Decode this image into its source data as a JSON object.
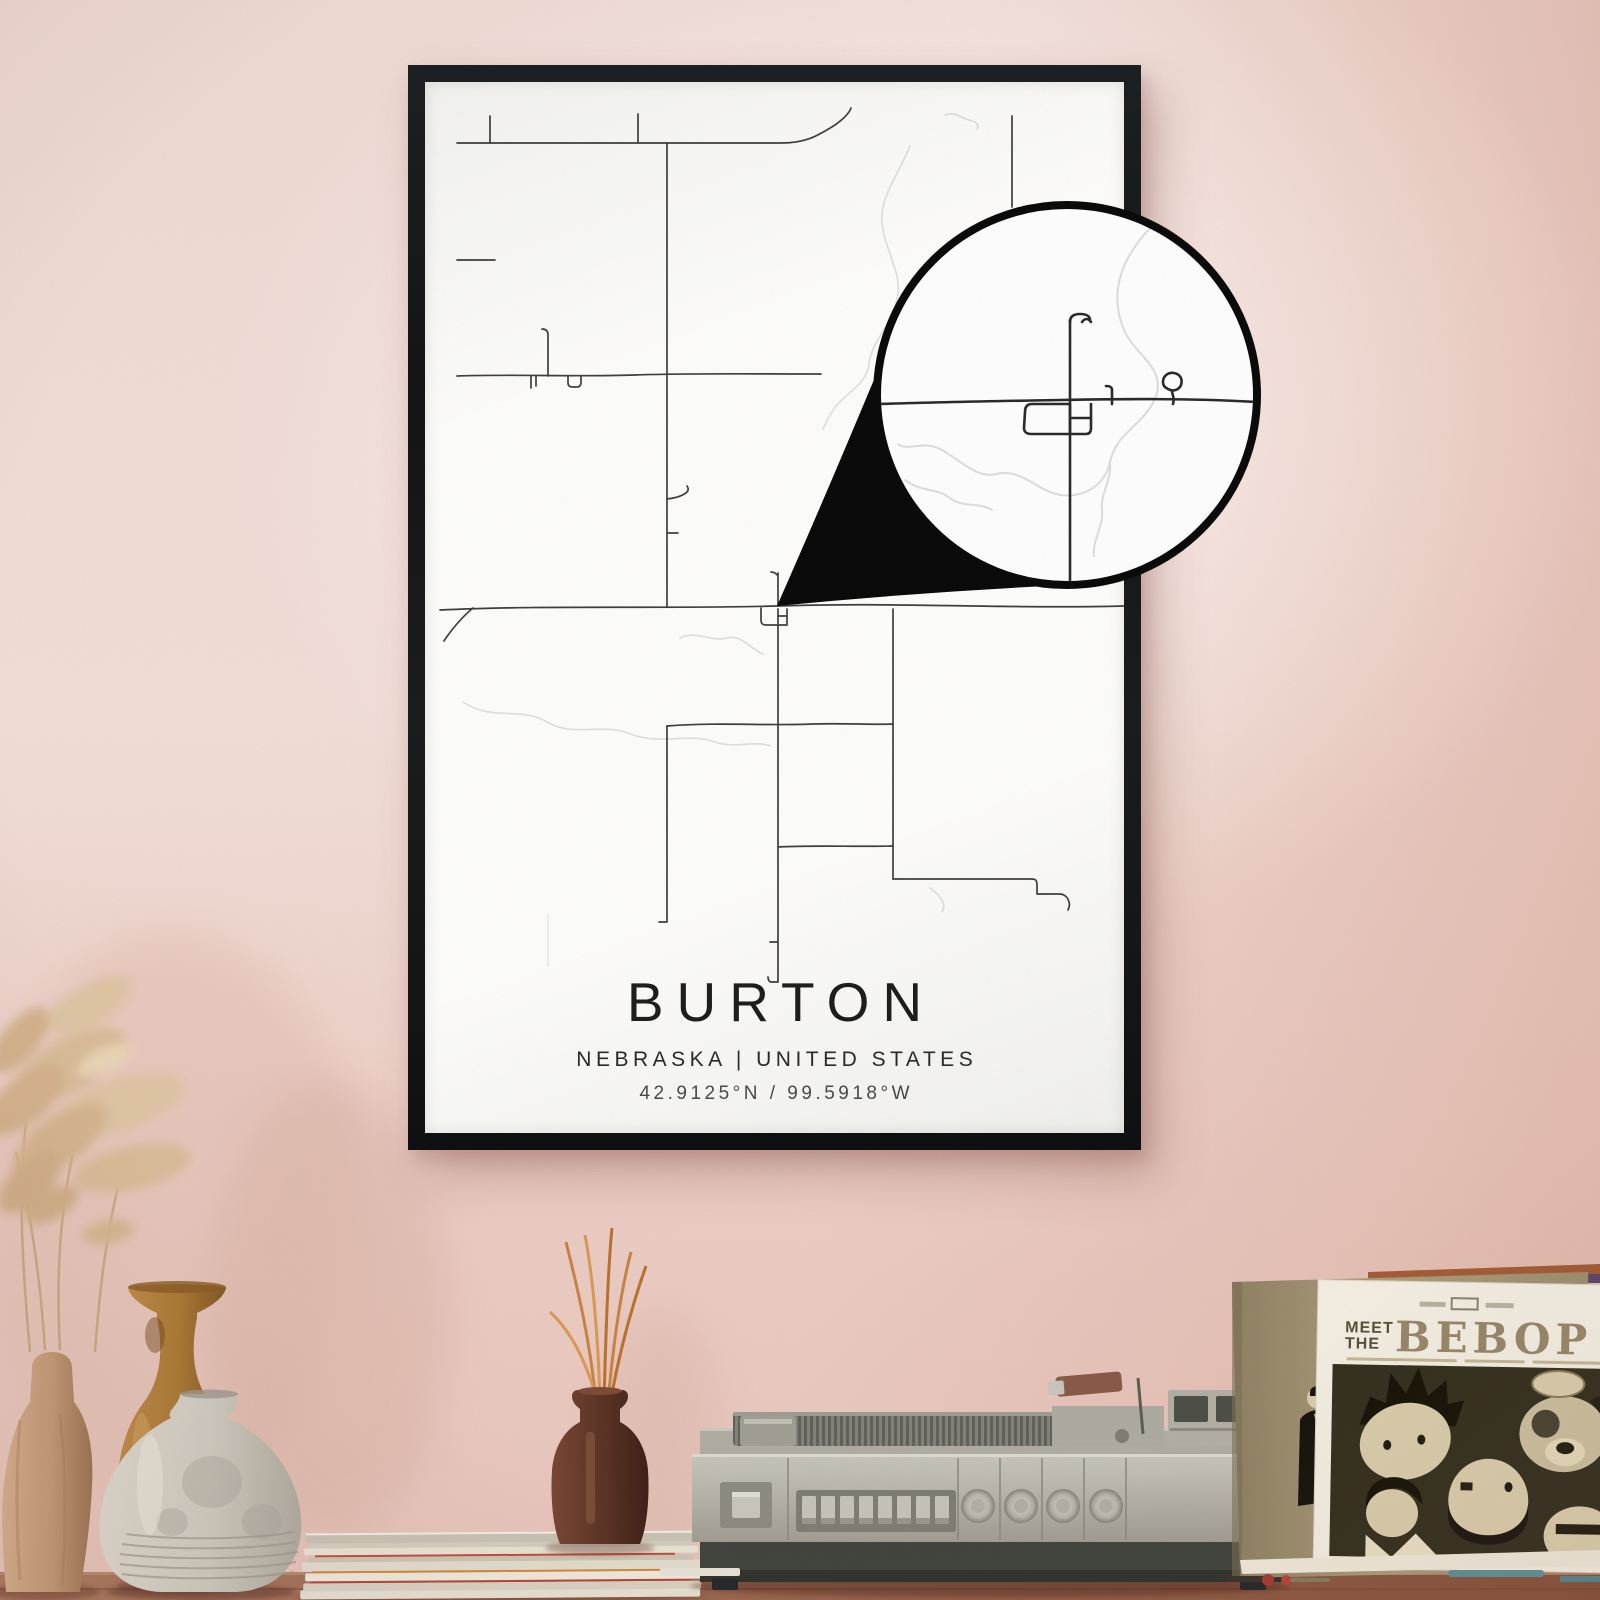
{
  "poster": {
    "title": "BURTON",
    "subtitle": "NEBRASKA | UNITED STATES",
    "coordinates": "42.9125°N / 99.5918°W"
  },
  "album": {
    "prefix_line1": "MEET",
    "prefix_line2": "THE",
    "title": "BEBOP"
  },
  "colors": {
    "wall_pink": "#efd8d1",
    "wall_salmon": "#e3bcb0",
    "frame_black": "#17191b",
    "poster_paper": "#fdfdfc",
    "map_road": "#3f3f3f",
    "map_water": "#d7dadb",
    "callout_black": "#0b0b0c",
    "album_title_brown": "#97876a",
    "album_art_dark": "#35301f",
    "album_art_cream": "#d9cdab",
    "table_wood": "#8b573f",
    "record_player_gray": "#b3b0a6",
    "incense_bottle_brown": "#5d3526",
    "amber_vase": "#b5813f",
    "tan_vase": "#c49c79",
    "stone_vase": "#d6d2c7"
  }
}
